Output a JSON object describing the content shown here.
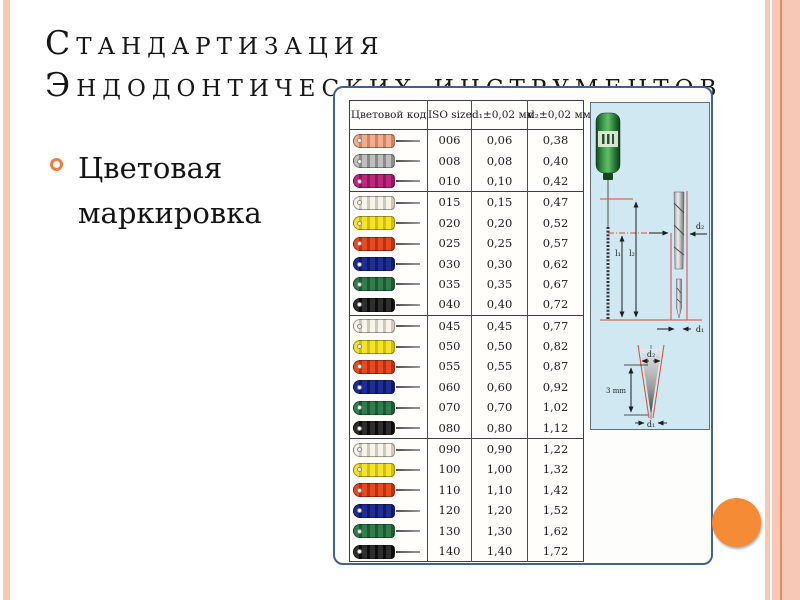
{
  "slide": {
    "title": {
      "line1": "Стандартизация",
      "line2": "Эндодонтических инструментов"
    },
    "bullet_text": "Цветовая маркировка"
  },
  "figure": {
    "table": {
      "headers": [
        "Цветовой код",
        "ISO size",
        "d₁±0,02 мм",
        "d₂±0,02 мм"
      ],
      "groups": [
        {
          "rows": [
            {
              "color": "pink",
              "iso": "006",
              "d1": "0,06",
              "d2": "0,38"
            },
            {
              "color": "grey",
              "iso": "008",
              "d1": "0,08",
              "d2": "0,40"
            },
            {
              "color": "magenta",
              "iso": "010",
              "d1": "0,10",
              "d2": "0,42"
            }
          ]
        },
        {
          "rows": [
            {
              "color": "white",
              "iso": "015",
              "d1": "0,15",
              "d2": "0,47"
            },
            {
              "color": "yellow",
              "iso": "020",
              "d1": "0,20",
              "d2": "0,52"
            },
            {
              "color": "red",
              "iso": "025",
              "d1": "0,25",
              "d2": "0,57"
            },
            {
              "color": "blue",
              "iso": "030",
              "d1": "0,30",
              "d2": "0,62"
            },
            {
              "color": "green",
              "iso": "035",
              "d1": "0,35",
              "d2": "0,67"
            },
            {
              "color": "black",
              "iso": "040",
              "d1": "0,40",
              "d2": "0,72"
            }
          ]
        },
        {
          "rows": [
            {
              "color": "white",
              "iso": "045",
              "d1": "0,45",
              "d2": "0,77"
            },
            {
              "color": "yellow",
              "iso": "050",
              "d1": "0,50",
              "d2": "0,82"
            },
            {
              "color": "red",
              "iso": "055",
              "d1": "0,55",
              "d2": "0,87"
            },
            {
              "color": "blue",
              "iso": "060",
              "d1": "0,60",
              "d2": "0,92"
            },
            {
              "color": "green",
              "iso": "070",
              "d1": "0,70",
              "d2": "1,02"
            },
            {
              "color": "black",
              "iso": "080",
              "d1": "0,80",
              "d2": "1,12"
            }
          ]
        },
        {
          "rows": [
            {
              "color": "white",
              "iso": "090",
              "d1": "0,90",
              "d2": "1,22"
            },
            {
              "color": "yellow",
              "iso": "100",
              "d1": "1,00",
              "d2": "1,32"
            },
            {
              "color": "red",
              "iso": "110",
              "d1": "1,10",
              "d2": "1,42"
            },
            {
              "color": "blue",
              "iso": "120",
              "d1": "1,20",
              "d2": "1,52"
            },
            {
              "color": "green",
              "iso": "130",
              "d1": "1,30",
              "d2": "1,62"
            },
            {
              "color": "black",
              "iso": "140",
              "d1": "1,40",
              "d2": "1,72"
            }
          ]
        }
      ],
      "handle_colors": {
        "pink": {
          "base": "#f0ae90",
          "band": "#d08463"
        },
        "grey": {
          "base": "#bfbfbf",
          "band": "#8b8b8b"
        },
        "magenta": {
          "base": "#c02580",
          "band": "#8d1a5d"
        },
        "white": {
          "base": "#f7f4ec",
          "band": "#cfc9bb"
        },
        "yellow": {
          "base": "#f4e428",
          "band": "#d2bd12"
        },
        "red": {
          "base": "#e8491f",
          "band": "#b93110"
        },
        "blue": {
          "base": "#1e2d9c",
          "band": "#121a62"
        },
        "green": {
          "base": "#2f7e4c",
          "band": "#1b5a33"
        },
        "black": {
          "base": "#2e2e2e",
          "band": "#0d0d0d"
        }
      }
    },
    "diagram": {
      "labels": {
        "l1": "l₁",
        "l2": "l₂",
        "d2": "d₂",
        "d1": "d₁",
        "tip_len": "3 mm"
      }
    }
  },
  "colors": {
    "accent_circle": "#f68b35",
    "edge_stripe": "#f7c8b5",
    "edge_stripe_line": "#e98a50",
    "panel_border": "#44618b",
    "diagram_bg": "#cfe8f2",
    "bullet_ring": "#e8803c"
  }
}
